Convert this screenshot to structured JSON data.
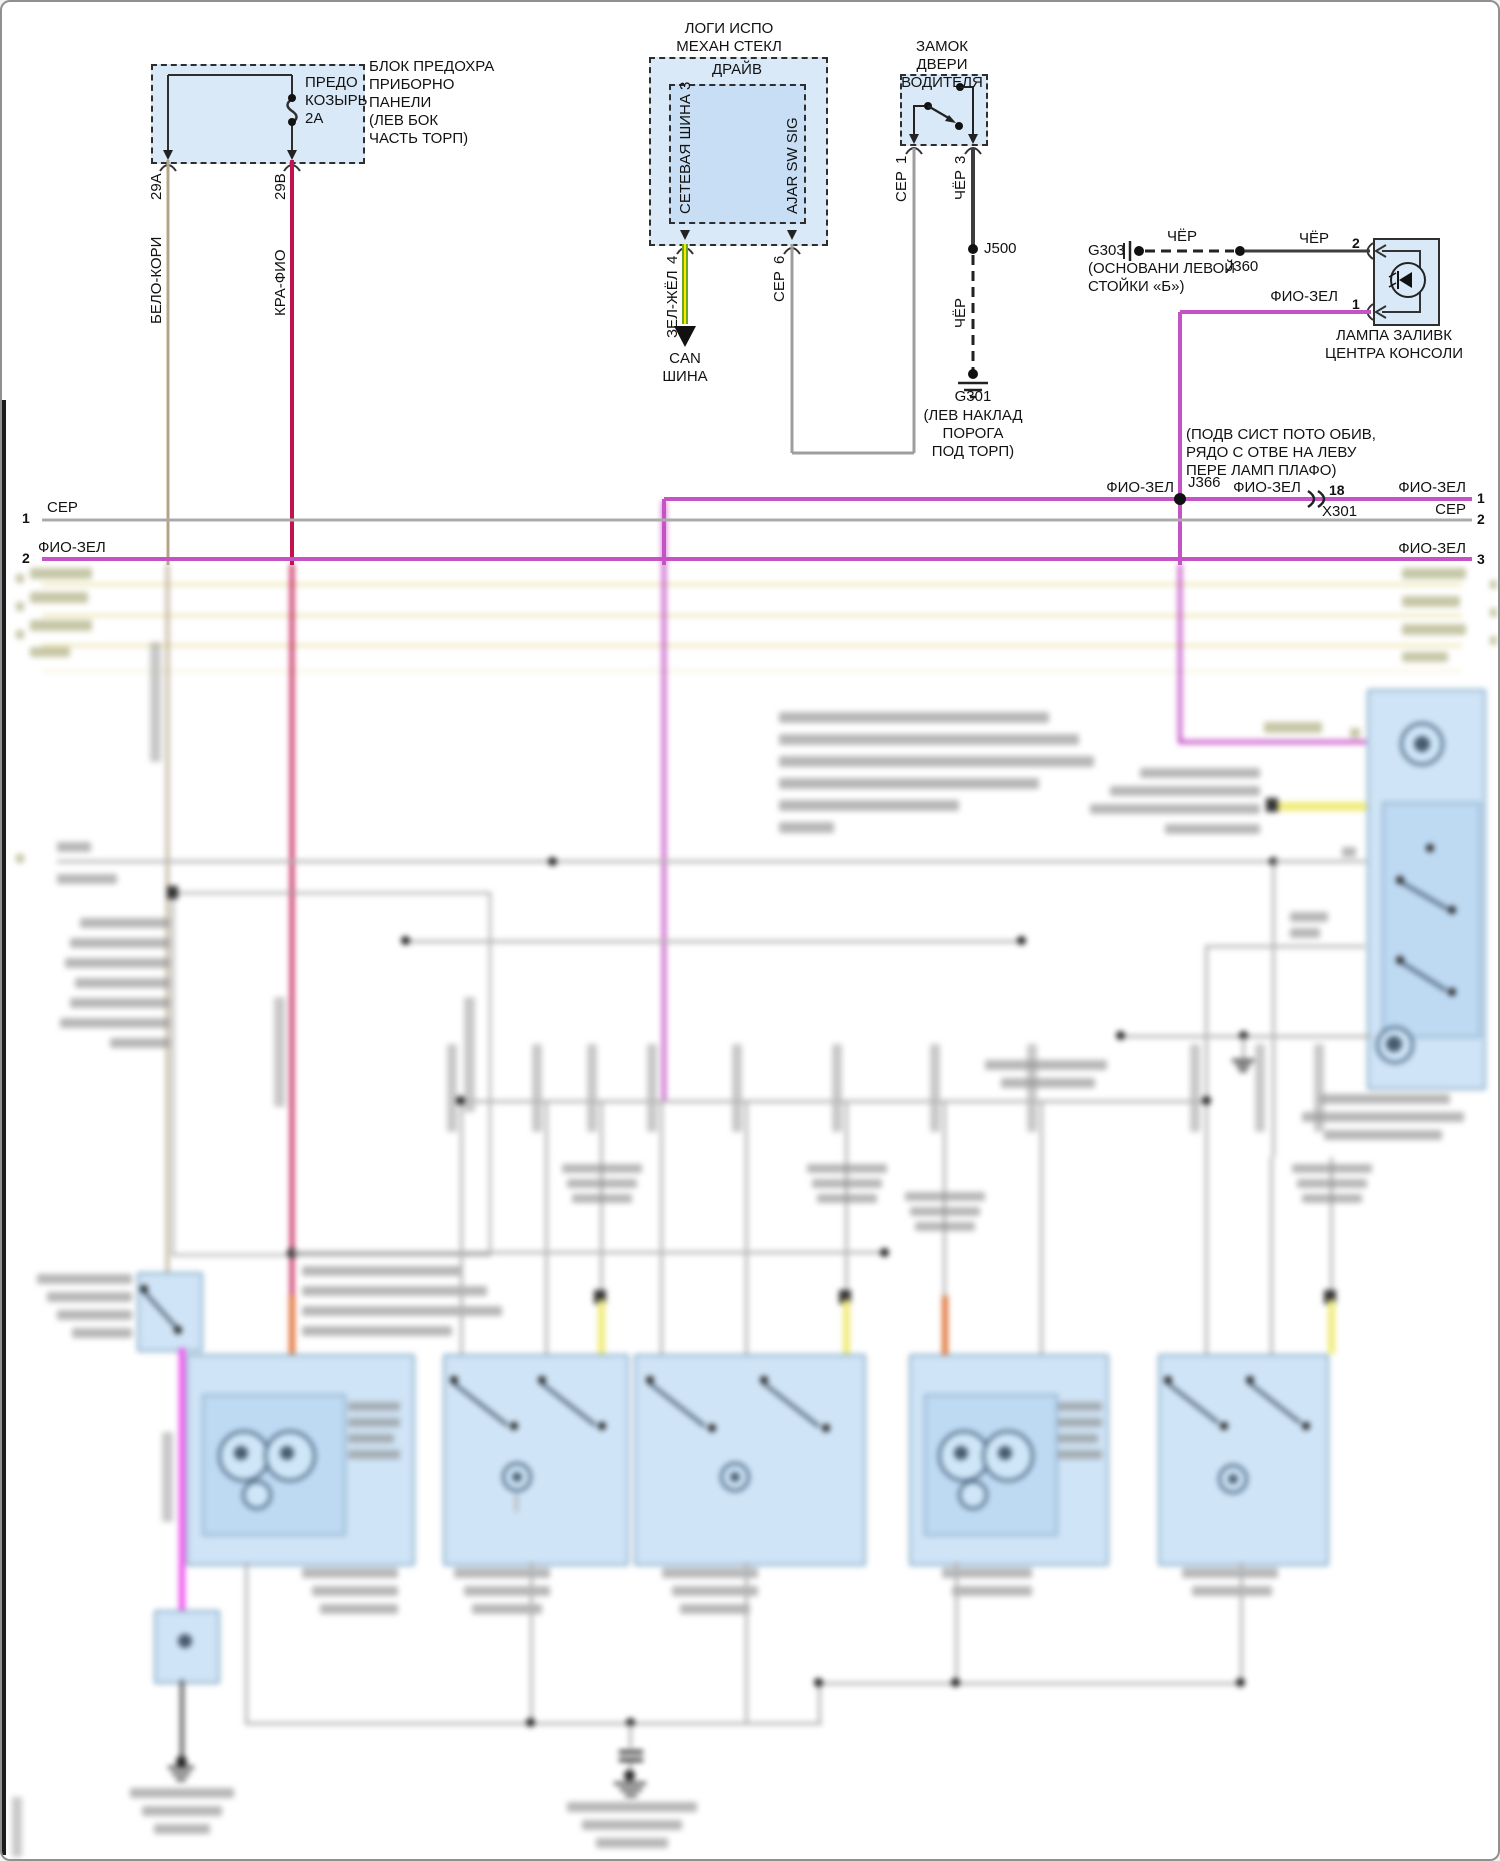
{
  "diagram": {
    "fuse_box": {
      "label": "БЛОК ПРЕДОХРА\nПРИБОРНО\nПАНЕЛИ\n(ЛЕВ БОК\nЧАСТЬ ТОРП)",
      "fuse": "ПРЕДО\nКОЗЫРЬ\n2А",
      "pin_a": "29А",
      "pin_b": "29В",
      "wire_a": "БЕЛО-КОРИ",
      "wire_b": "КРА-ФИО"
    },
    "window_module": {
      "title": "ЛОГИ ИСПО\nМЕХАН СТЕКЛ",
      "sub": "ДРАЙВ",
      "sig_left": "СЕТЕВАЯ ШИНА 3",
      "sig_right": "AJAR SW SIG",
      "pin_left": "4",
      "pin_right": "6",
      "wire_left": "ЗЕЛ-ЖЁЛ",
      "wire_right": "СЕР",
      "can": "CAN\nШИНА"
    },
    "door_lock": {
      "title": "ЗАМОК ДВЕРИ\nВОДИТЕЛЯ",
      "pin_left": "1",
      "pin_right": "3",
      "wire_left": "СЕР",
      "wire_right": "ЧЁР"
    },
    "j500": {
      "label": "J500",
      "wire": "ЧЁР"
    },
    "g301": {
      "label": "G301",
      "note": "(ЛЕВ НАКЛАД ПОРОГА\nПОД ТОРП)"
    },
    "g303": {
      "label": "G303",
      "note": "(ОСНОВАНИ ЛЕВОЙ\nСТОЙКИ «Б»)",
      "wire": "ЧЁР"
    },
    "j360": {
      "label": "J360",
      "wire": "ЧЁР"
    },
    "console_lamp": {
      "pin_top": "2",
      "pin_bottom": "1",
      "wire_bottom": "ФИО-ЗЕЛ",
      "label": "ЛАМПА ЗАЛИВК\nЦЕНТРА КОНСОЛИ"
    },
    "j366": {
      "label": "J366",
      "note": "(ПОДВ СИСТ ПОТО ОБИВ,\nРЯДО С ОТВЕ НА ЛЕВУ\nПЕРЕ ЛАМП ПЛАФО)",
      "wire_left": "ФИО-ЗЕЛ",
      "wire_right": "ФИО-ЗЕЛ"
    },
    "x301": {
      "pin": "18",
      "label": "X301"
    },
    "bus": {
      "left": [
        {
          "num": "1",
          "wire": "СЕР"
        },
        {
          "num": "2",
          "wire": "ФИО-ЗЕЛ"
        }
      ],
      "right": [
        {
          "num": "1",
          "wire": "ФИО-ЗЕЛ"
        },
        {
          "num": "2",
          "wire": "СЕР"
        },
        {
          "num": "3",
          "wire": "ФИО-ЗЕЛ"
        }
      ]
    },
    "colors": {
      "wire_gray": "#ababab",
      "wire_black": "#3d3d3d",
      "wire_tan": "#b5a487",
      "wire_crimson": "#c3134f",
      "wire_green": "#6aaa1e",
      "wire_green_stripe": "#ffe800",
      "wire_violet": "#c653c6",
      "wire_pink": "#ee52ee",
      "wire_yellow": "#f0ec7a",
      "wire_orange": "#e0763c",
      "box_fill": "#d9e9f8",
      "box_fill_inner": "#c7def4"
    }
  }
}
